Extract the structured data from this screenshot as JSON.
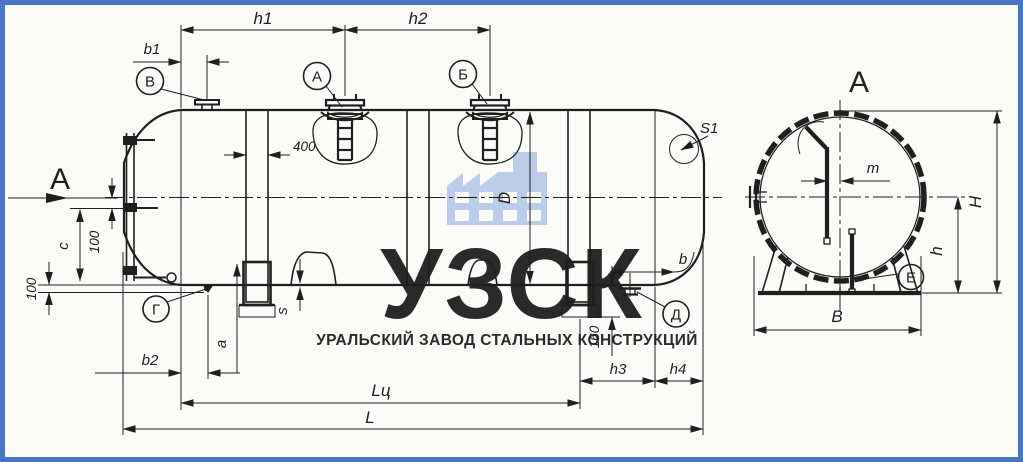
{
  "drawing": {
    "watermark": {
      "logo": "УЗСК",
      "subtitle": "УРАЛЬСКИЙ ЗАВОД СТАЛЬНЫХ КОНСТРУКЦИЙ"
    },
    "views": {
      "section_arrow_label": "А",
      "section_title": "А"
    },
    "dims": {
      "h1": "h1",
      "h2": "h2",
      "b1": "b1",
      "b2": "b2",
      "band_width": "400",
      "diameter": "D",
      "c": "c",
      "c_offset": "100",
      "bottom_offset": "100",
      "a": "a",
      "s": "s",
      "s1": "S1",
      "b": "b",
      "support_height": "160",
      "h3": "h3",
      "h4": "h4",
      "length_cyl": "Lц",
      "length_total": "L",
      "m": "m",
      "height_total": "H",
      "height_axis": "h",
      "base_width": "B"
    },
    "callouts": {
      "a": "А",
      "b": "Б",
      "v": "В",
      "g": "Г",
      "d": "Д",
      "e": "Е"
    },
    "colors": {
      "line": "#1f1f1f",
      "frame": "#4a74c4",
      "watermark_logo": "#c9d3e9",
      "watermark_text": "#a9bddf",
      "watermark_icon": "#b9c9e7"
    }
  }
}
